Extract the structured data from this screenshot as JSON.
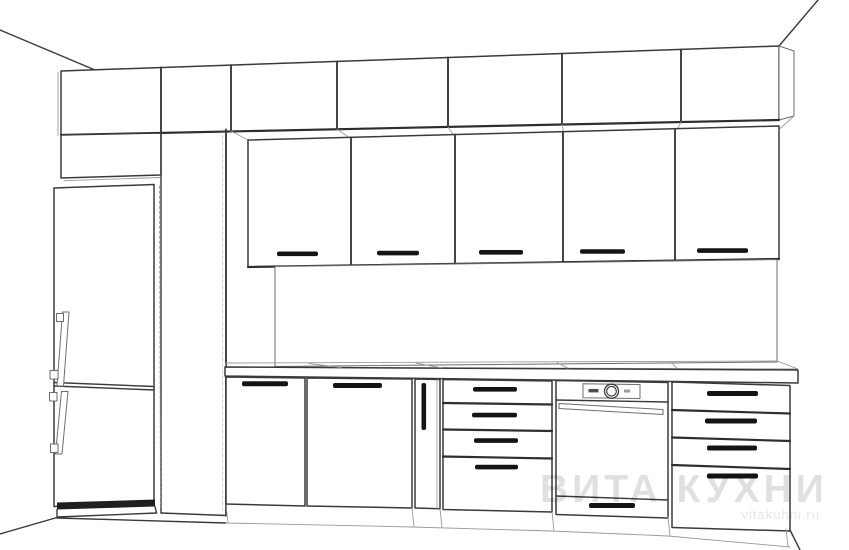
{
  "watermark": {
    "brand": "ВИТА КУХНИ",
    "website": "vitakuhni.ru"
  },
  "palette": {
    "background": "#ffffff",
    "line": "#3a3a3a",
    "line_soft": "#9a9a9a",
    "handle_fill": "#141414",
    "fridge_plinth": "#1f1f1f",
    "watermark_color": "rgba(0,0,0,0.12)"
  },
  "drawing": {
    "type": "kitchen-design-line-render",
    "components": {
      "refrigerator": {
        "doors": 2,
        "handle_style": "vertical-bar",
        "position": "left"
      },
      "tall_cabinet_columns": 1,
      "top_cabinet_row_doors": 7,
      "wall_cabinet_doors": 5,
      "wall_handle_style": "horizontal-bar",
      "base_doors": 2,
      "narrow_base_door": 1,
      "drawer_units": 2,
      "drawers_per_unit": 4,
      "oven": {
        "knobs": 1,
        "display": 1,
        "handle_style": "long-bar",
        "bottom_drawer": true
      },
      "backsplash_panel": 1,
      "countertop": 1
    }
  }
}
